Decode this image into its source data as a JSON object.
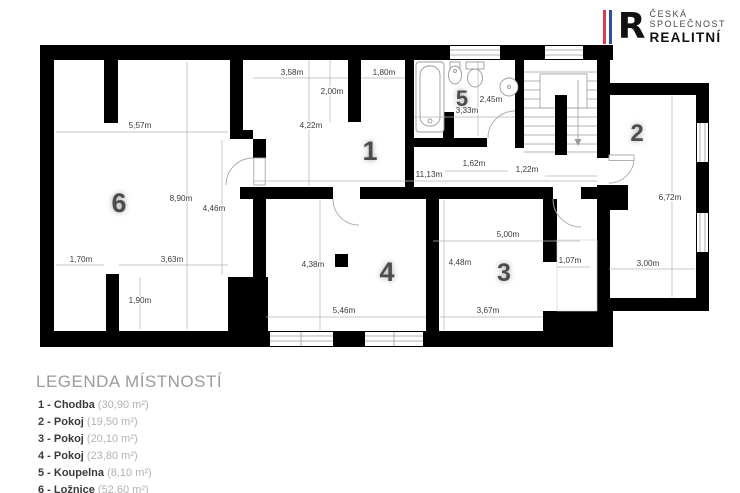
{
  "logo": {
    "letter": "R",
    "line1": "ČESKÁ",
    "line2": "SPOLEČNOST",
    "line3": "REALITNÍ",
    "stripe_red": "#d93f4a",
    "stripe_blue": "#2e4e9e"
  },
  "legend": {
    "title": "LEGENDA MÍSTNOSTÍ",
    "items": [
      {
        "label": "1 - Chodba",
        "area": "(30,90 m²)"
      },
      {
        "label": "2 - Pokoj",
        "area": "(19,50 m²)"
      },
      {
        "label": "3 - Pokoj",
        "area": "(20,10 m²)"
      },
      {
        "label": "4 - Pokoj",
        "area": "(23,80 m²)"
      },
      {
        "label": "5 - Koupelna",
        "area": "(8,10 m²)"
      },
      {
        "label": "6 - Ložnice",
        "area": "(52,60 m²)"
      }
    ],
    "footnote": "*Plocha místností je pouze orientační"
  },
  "plan": {
    "wall_color": "#000000",
    "rooms": [
      {
        "num": "1",
        "x": 370,
        "y": 160,
        "size": 27
      },
      {
        "num": "2",
        "x": 637,
        "y": 141,
        "size": 24
      },
      {
        "num": "3",
        "x": 504,
        "y": 281,
        "size": 25
      },
      {
        "num": "4",
        "x": 387,
        "y": 281,
        "size": 27
      },
      {
        "num": "5",
        "x": 462,
        "y": 106,
        "size": 22
      },
      {
        "num": "6",
        "x": 119,
        "y": 212,
        "size": 27
      }
    ],
    "dimensions": [
      {
        "text": "5,57m",
        "x": 140,
        "y": 128
      },
      {
        "text": "8,90m",
        "x": 181,
        "y": 201
      },
      {
        "text": "4,46m",
        "x": 214,
        "y": 211
      },
      {
        "text": "1,70m",
        "x": 81,
        "y": 262
      },
      {
        "text": "3,63m",
        "x": 172,
        "y": 262
      },
      {
        "text": "1,90m",
        "x": 140,
        "y": 303
      },
      {
        "text": "3,58m",
        "x": 292,
        "y": 75
      },
      {
        "text": "1,80m",
        "x": 384,
        "y": 75
      },
      {
        "text": "2,00m",
        "x": 332,
        "y": 94
      },
      {
        "text": "4,22m",
        "x": 311,
        "y": 128
      },
      {
        "text": "11,13m",
        "x": 429,
        "y": 177
      },
      {
        "text": "1,62m",
        "x": 474,
        "y": 166
      },
      {
        "text": "1,22m",
        "x": 527,
        "y": 172
      },
      {
        "text": "2,45m",
        "x": 491,
        "y": 102
      },
      {
        "text": "3,33m",
        "x": 467,
        "y": 113
      },
      {
        "text": "6,72m",
        "x": 670,
        "y": 200
      },
      {
        "text": "3,00m",
        "x": 648,
        "y": 266
      },
      {
        "text": "5,00m",
        "x": 508,
        "y": 237
      },
      {
        "text": "4,48m",
        "x": 460,
        "y": 265
      },
      {
        "text": "1,07m",
        "x": 570,
        "y": 263
      },
      {
        "text": "3,67m",
        "x": 488,
        "y": 313
      },
      {
        "text": "5,46m",
        "x": 344,
        "y": 313
      },
      {
        "text": "4,38m",
        "x": 313,
        "y": 267
      }
    ]
  }
}
